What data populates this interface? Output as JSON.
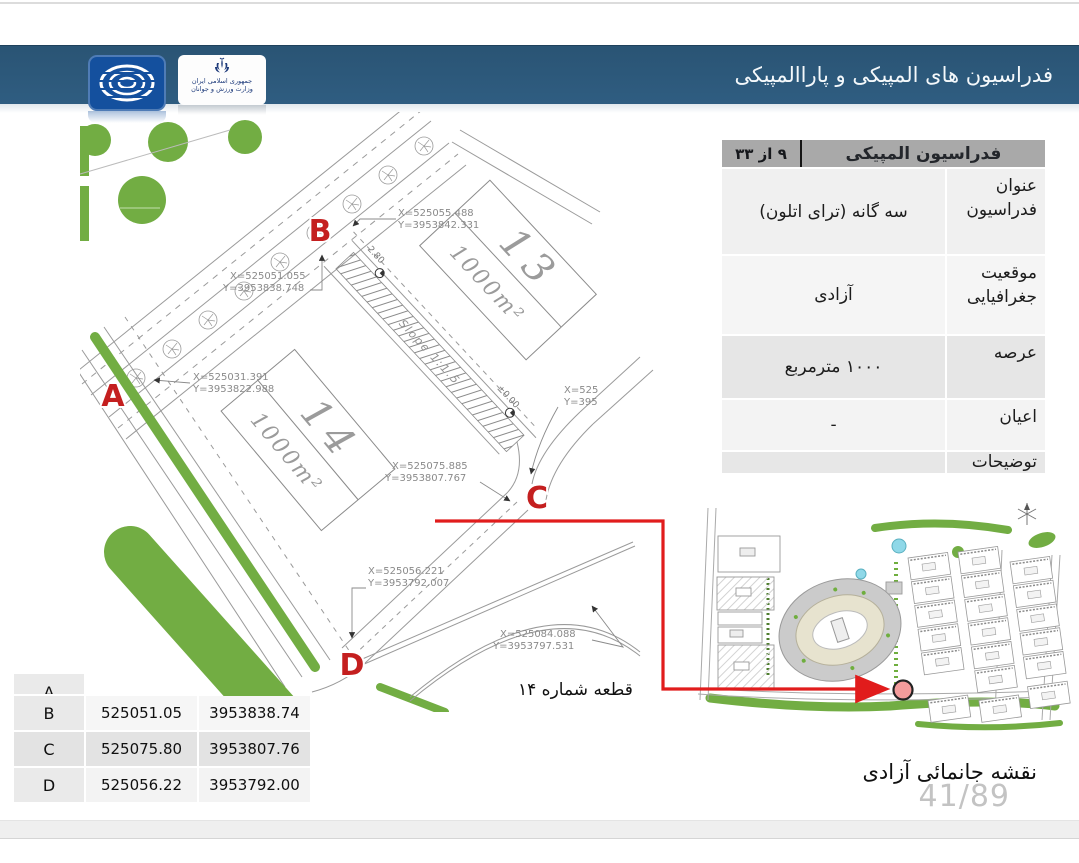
{
  "header": {
    "title": "فدراسیون های المپیکی و پاراالمپیکی",
    "ministry_line1": "جمهوری اسلامی ایران",
    "ministry_line2": "وزارت ورزش و جوانان"
  },
  "info_table": {
    "title": "فدراسیون المپیکی",
    "page_badge": "۹ از ۳۳",
    "rows": [
      {
        "label": "عنوان فدراسیون",
        "value": "سه گانه (ترای اتلون)"
      },
      {
        "label": "موقعیت جغرافیایی",
        "value": "آزادی"
      },
      {
        "label": "عرصه",
        "value": "۱۰۰۰ مترمربع"
      },
      {
        "label": "اعیان",
        "value": "-"
      },
      {
        "label": "توضیحات",
        "value": ""
      }
    ]
  },
  "drawing": {
    "plot13_number": "13",
    "plot13_area": "1000m²",
    "plot14_number": "14",
    "plot14_area": "1000m²",
    "slope_label": "Slope 1:1.5",
    "dim_280": "2.80",
    "dim_000": "±0.00",
    "point_a": "A",
    "point_b": "B",
    "point_c": "C",
    "point_d": "D",
    "ann_b_top_x": "X=525055.488",
    "ann_b_top_y": "Y=3953842.331",
    "ann_b_x": "X=525051.055",
    "ann_b_y": "Y=3953838.748",
    "ann_a_x": "X=525031.391",
    "ann_a_y": "Y=3953822.988",
    "ann_c_x": "X=525075.885",
    "ann_c_y": "Y=3953807.767",
    "ann_right_x": "X=525",
    "ann_right_y": "Y=395",
    "ann_d_x": "X=525056.221",
    "ann_d_y": "Y=3953792.007",
    "ann_e_x": "X=525084.088",
    "ann_e_y": "Y=3953797.531"
  },
  "callout": {
    "label": "قطعه شماره ۱۴"
  },
  "coords_table": {
    "rows": [
      {
        "point": "A",
        "x": "",
        "y": ""
      },
      {
        "point": "B",
        "x": "525051.05",
        "y": "3953838.74"
      },
      {
        "point": "C",
        "x": "525075.80",
        "y": "3953807.76"
      },
      {
        "point": "D",
        "x": "525056.22",
        "y": "3953792.00"
      }
    ]
  },
  "footer": {
    "caption": "نقشه جانمائی آزادی",
    "page_number": "41/89"
  }
}
